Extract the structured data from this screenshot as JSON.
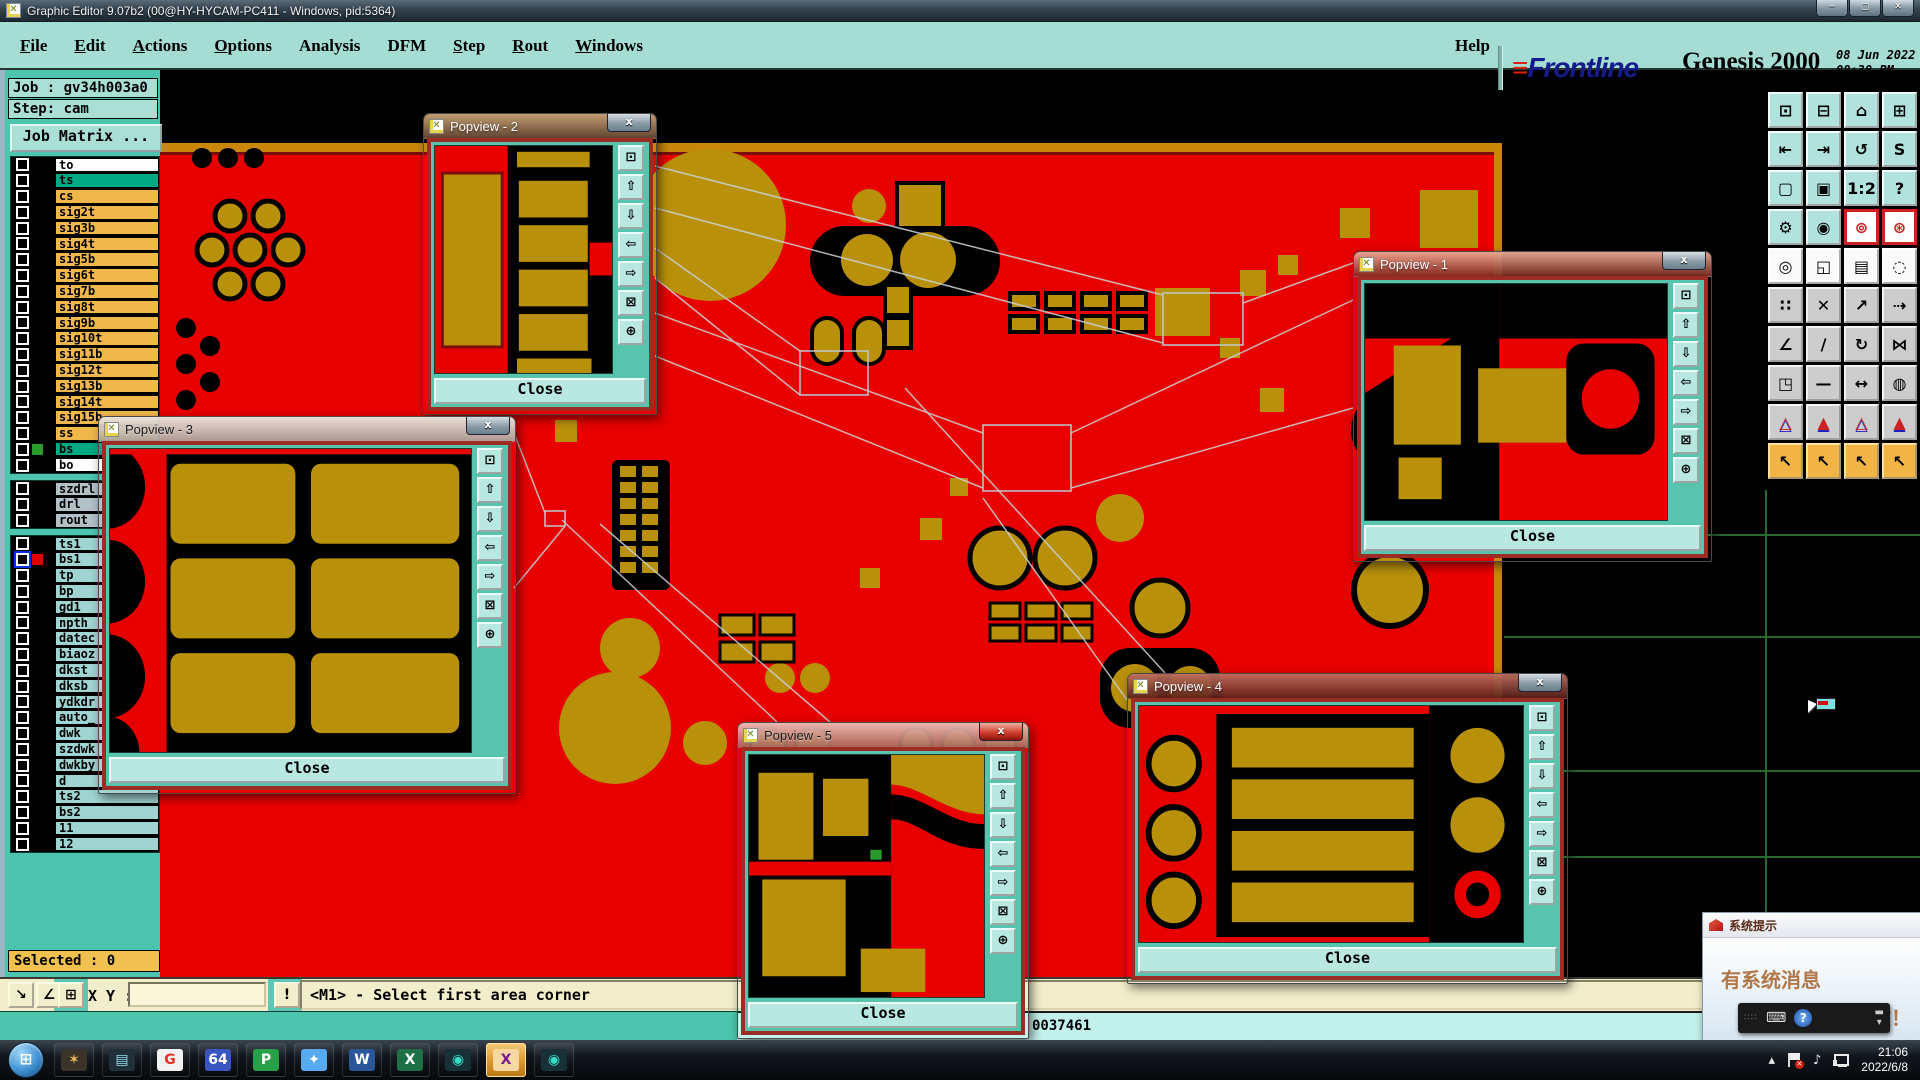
{
  "titlebar": {
    "title": "Graphic Editor 9.07b2 (00@HY-HYCAM-PC411 - Windows, pid:5364)",
    "minimize": "─",
    "maximize": "▢",
    "close": "✕"
  },
  "menubar": {
    "menus": [
      {
        "label": "File",
        "u": 0
      },
      {
        "label": "Edit",
        "u": 0
      },
      {
        "label": "Actions",
        "u": 0
      },
      {
        "label": "Options",
        "u": 0
      },
      {
        "label": "Analysis",
        "u": -1
      },
      {
        "label": "DFM",
        "u": -1
      },
      {
        "label": "Step",
        "u": 0
      },
      {
        "label": "Rout",
        "u": 0
      },
      {
        "label": "Windows",
        "u": 0
      }
    ],
    "help": "Help"
  },
  "brand": {
    "stripes": "≡",
    "logo": "Frontline",
    "product": "Genesis 2000",
    "edition": "Graphic Editor",
    "date": "08 Jun 2022",
    "time": "08:38 PM"
  },
  "sidebar": {
    "job_label": "Job : gv34h003a0",
    "step_label": "Step: cam",
    "job_matrix_button": "Job Matrix ...",
    "selected_status": "Selected : 0",
    "layer_groups": [
      {
        "rows": [
          {
            "label": "to",
            "bg": "white"
          },
          {
            "label": "ts",
            "bg": "teal"
          },
          {
            "label": "cs",
            "bg": "orange"
          },
          {
            "label": "sig2t",
            "bg": "orange"
          },
          {
            "label": "sig3b",
            "bg": "orange"
          },
          {
            "label": "sig4t",
            "bg": "orange"
          },
          {
            "label": "sig5b",
            "bg": "orange"
          },
          {
            "label": "sig6t",
            "bg": "orange"
          },
          {
            "label": "sig7b",
            "bg": "orange"
          },
          {
            "label": "sig8t",
            "bg": "orange"
          },
          {
            "label": "sig9b",
            "bg": "orange"
          },
          {
            "label": "sig10t",
            "bg": "orange"
          },
          {
            "label": "sig11b",
            "bg": "orange"
          },
          {
            "label": "sig12t",
            "bg": "orange"
          },
          {
            "label": "sig13b",
            "bg": "orange"
          },
          {
            "label": "sig14t",
            "bg": "orange"
          },
          {
            "label": "sig15b",
            "bg": "orange"
          },
          {
            "label": "ss",
            "bg": "orange"
          },
          {
            "label": "bs",
            "bg": "teal",
            "swatch": "#2a9a2a"
          },
          {
            "label": "bo",
            "bg": "white"
          }
        ]
      },
      {
        "rows": [
          {
            "label": "szdrl",
            "bg": "gray"
          },
          {
            "label": "drl",
            "bg": "gray"
          },
          {
            "label": "rout",
            "bg": "gray"
          }
        ]
      },
      {
        "rows": [
          {
            "label": "ts1",
            "bg": "cyan"
          },
          {
            "label": "bs1",
            "bg": "cyan",
            "swatch": "#e00000",
            "cb": "sel"
          },
          {
            "label": "tp",
            "bg": "cyan"
          },
          {
            "label": "bp",
            "bg": "cyan"
          },
          {
            "label": "gd1",
            "bg": "cyan"
          },
          {
            "label": "npth",
            "bg": "cyan"
          },
          {
            "label": "datec",
            "bg": "cyan"
          },
          {
            "label": "biaoz",
            "bg": "cyan"
          },
          {
            "label": "dkst",
            "bg": "cyan"
          },
          {
            "label": "dksb",
            "bg": "cyan"
          },
          {
            "label": "ydkdr",
            "bg": "cyan"
          },
          {
            "label": "auto_",
            "bg": "cyan"
          },
          {
            "label": "dwk",
            "bg": "cyan"
          },
          {
            "label": "szdwk",
            "bg": "cyan"
          },
          {
            "label": "dwkby",
            "bg": "cyan"
          },
          {
            "label": "d",
            "bg": "cyan"
          },
          {
            "label": "ts2",
            "bg": "cyan"
          },
          {
            "label": "bs2",
            "bg": "cyan"
          },
          {
            "label": "11",
            "bg": "cyan"
          },
          {
            "label": "12",
            "bg": "cyan"
          }
        ]
      }
    ]
  },
  "popviews": [
    {
      "title": "Popview - 1",
      "close_label": "Close"
    },
    {
      "title": "Popview - 2",
      "close_label": "Close"
    },
    {
      "title": "Popview - 3",
      "close_label": "Close"
    },
    {
      "title": "Popview - 4",
      "close_label": "Close"
    },
    {
      "title": "Popview - 5",
      "close_label": "Close"
    }
  ],
  "popview_close_x": "x",
  "popview_tool_buttons": [
    {
      "glyph": "⊡",
      "name": "popview-detach-window"
    },
    {
      "glyph": "⇧",
      "name": "popview-pan-up"
    },
    {
      "glyph": "⇩",
      "name": "popview-pan-down"
    },
    {
      "glyph": "⇦",
      "name": "popview-pan-left"
    },
    {
      "glyph": "⇨",
      "name": "popview-pan-right"
    },
    {
      "glyph": "⊠",
      "name": "popview-zoom-in"
    },
    {
      "glyph": "⊕",
      "name": "popview-zoom-out"
    }
  ],
  "statusbar": {
    "tool_buttons": [
      {
        "glyph": "↘",
        "name": "measure-diagonal"
      },
      {
        "glyph": "∠",
        "name": "snap-angle"
      },
      {
        "glyph": "⊞",
        "name": "grid-toggle"
      }
    ],
    "xy_label": "X Y :",
    "xy_value": "",
    "alert_label": "!",
    "message": "<M1> - Select first area corner"
  },
  "counter_strip": {
    "value": "0037461"
  },
  "toolbar_right": {
    "buttons": [
      {
        "g": "⊡",
        "s": "teal",
        "n": "clipboard-view"
      },
      {
        "g": "⊟",
        "s": "teal",
        "n": "screen-dump"
      },
      {
        "g": "⌂",
        "s": "teal",
        "n": "home-view"
      },
      {
        "g": "⊞",
        "s": "teal",
        "n": "split-window-xy"
      },
      {
        "g": "⇤",
        "s": "teal",
        "n": "pan-view-left"
      },
      {
        "g": "⇥",
        "s": "teal",
        "n": "pan-view-right"
      },
      {
        "g": "↺",
        "s": "teal",
        "n": "previous-view"
      },
      {
        "g": "S",
        "s": "teal",
        "n": "s-shape-select"
      },
      {
        "g": "▢",
        "s": "teal",
        "n": "zoom-out-box"
      },
      {
        "g": "▣",
        "s": "teal",
        "n": "zoom-center"
      },
      {
        "g": "1:2",
        "s": "teal",
        "n": "zoom-ratio"
      },
      {
        "g": "?",
        "s": "teal",
        "n": "help-mode"
      },
      {
        "g": "⚙",
        "s": "teal",
        "n": "setup-tools"
      },
      {
        "g": "◉",
        "s": "teal",
        "n": "net-trace"
      },
      {
        "g": "⊚",
        "s": "red",
        "n": "highlight-nets-a"
      },
      {
        "g": "⊛",
        "s": "red",
        "n": "highlight-nets-b"
      },
      {
        "g": "◎",
        "s": "white",
        "n": "copy-select"
      },
      {
        "g": "◱",
        "s": "white",
        "n": "zoom-compare"
      },
      {
        "g": "▤",
        "s": "white",
        "n": "ruler-measure"
      },
      {
        "g": "◌",
        "s": "white",
        "n": "select-circle"
      },
      {
        "g": "∷",
        "s": "gray",
        "n": "net-endpoints"
      },
      {
        "g": "✕",
        "s": "gray",
        "n": "delete-object"
      },
      {
        "g": "↗",
        "s": "gray",
        "n": "move-origin"
      },
      {
        "g": "⇢",
        "s": "gray",
        "n": "move-point"
      },
      {
        "g": "∠",
        "s": "gray",
        "n": "rotate-angle"
      },
      {
        "g": "∕",
        "s": "gray",
        "n": "mirror-diagonal"
      },
      {
        "g": "↻",
        "s": "gray",
        "n": "rotate-90"
      },
      {
        "g": "⋈",
        "s": "gray",
        "n": "mirror-horizontal"
      },
      {
        "g": "◳",
        "s": "gray",
        "n": "copy-pad"
      },
      {
        "g": "—",
        "s": "gray",
        "n": "stretch-line"
      },
      {
        "g": "↔",
        "s": "gray",
        "n": "measure-distance"
      },
      {
        "g": "◍",
        "s": "gray",
        "n": "swap-shapes"
      },
      {
        "g": "△",
        "s": "gray tri",
        "n": "arc-mode-1"
      },
      {
        "g": "▲",
        "s": "gray tri",
        "n": "arc-mode-2"
      },
      {
        "g": "△",
        "s": "gray tri",
        "n": "arc-mode-3"
      },
      {
        "g": "▲",
        "s": "gray tri",
        "n": "arc-mode-4"
      },
      {
        "g": "↖",
        "s": "orange",
        "n": "select-cursor"
      },
      {
        "g": "↖",
        "s": "orange",
        "n": "select-frame"
      },
      {
        "g": "↖",
        "s": "orange",
        "n": "select-polygon"
      },
      {
        "g": "↖",
        "s": "orange",
        "n": "select-net-path"
      }
    ]
  },
  "taskbar": {
    "start_glyph": "⊞",
    "icons": [
      {
        "name": "shell-app-icon",
        "glyph": "✶",
        "fg": "#f0c060",
        "chip": "#3a3428"
      },
      {
        "name": "notepad-app-icon",
        "glyph": "▤",
        "fg": "#9adcf0",
        "chip": "#20303a"
      },
      {
        "name": "goldwave-app-icon",
        "glyph": "G",
        "fg": "#e03020",
        "chip": "#f2f2f2"
      },
      {
        "name": "floppy-save-app-icon",
        "glyph": "64",
        "fg": "#ffffff",
        "chip": "#3a55c0"
      },
      {
        "name": "pdf-app-icon",
        "glyph": "P",
        "fg": "#ffffff",
        "chip": "#28a048"
      },
      {
        "name": "messenger-app-icon",
        "glyph": "✦",
        "fg": "#ffffff",
        "chip": "#58aaf0"
      },
      {
        "name": "word-app-icon",
        "glyph": "W",
        "fg": "#ffffff",
        "chip": "#2b579a"
      },
      {
        "name": "excel-app-icon",
        "glyph": "X",
        "fg": "#ffffff",
        "chip": "#1e7145"
      },
      {
        "name": "genesis-app-icon",
        "glyph": "◉",
        "fg": "#30e0c8",
        "chip": "#183038"
      },
      {
        "name": "graphic-editor-app-icon",
        "glyph": "X",
        "fg": "#7a1890",
        "chip": "#f6d8a0",
        "active": true
      },
      {
        "name": "genesis-2-app-icon",
        "glyph": "◉",
        "fg": "#30e0c8",
        "chip": "#183038"
      }
    ],
    "tray": {
      "time": "21:06",
      "date": "2022/6/8",
      "expand": "▴"
    }
  },
  "notification": {
    "title": "系统提示",
    "line1": "有系统消息",
    "line2": "请注意查收！",
    "help": "?"
  }
}
